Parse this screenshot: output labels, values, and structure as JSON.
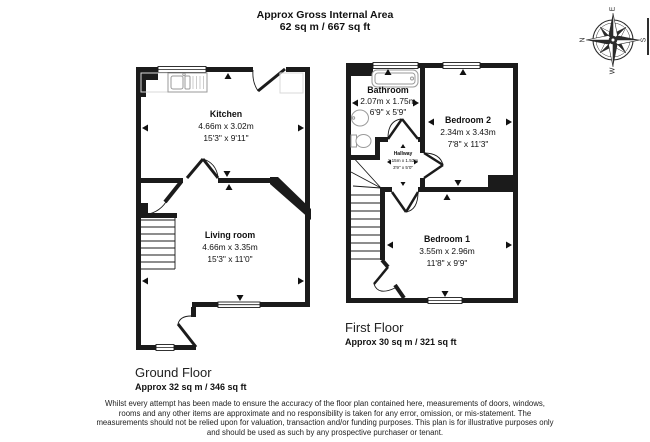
{
  "header": {
    "title": "Approx Gross Internal Area",
    "area_total": "62 sq m / 667 sq ft"
  },
  "compass": {
    "n": "N",
    "e": "E",
    "s": "S",
    "w": "W"
  },
  "ground_floor": {
    "title": "Ground Floor",
    "area": "Approx 32 sq m / 346 sq ft",
    "rooms": [
      {
        "name": "Kitchen",
        "metric": "4.66m x 3.02m",
        "imperial": "15'3\" x 9'11\""
      },
      {
        "name": "Living room",
        "metric": "4.66m x 3.35m",
        "imperial": "15'3\" x 11'0\""
      }
    ]
  },
  "first_floor": {
    "title": "First Floor",
    "area": "Approx 30 sq m / 321 sq ft",
    "rooms": [
      {
        "name": "Bathroom",
        "metric": "2.07m x 1.75m",
        "imperial": "6'9\" x 5'9\""
      },
      {
        "name": "Bedroom 2",
        "metric": "2.34m x 3.43m",
        "imperial": "7'8\" x 11'3\""
      },
      {
        "name": "Hallway",
        "metric": "1.15m x 1.53m",
        "imperial": "3'9\" x 5'0\""
      },
      {
        "name": "Bedroom 1",
        "metric": "3.55m x 2.96m",
        "imperial": "11'8\" x 9'9\""
      }
    ]
  },
  "disclaimer": "Whilst every attempt has been made to ensure the accuracy of the floor plan contained here, measurements of doors, windows, rooms and any other items are approximate and no responsibility is taken for any error, omission, or mis-statement. The measurements should not be relied upon for valuation, transaction and/or funding purposes. This plan is for illustrative purposes only and should be used as such by any prospective purchaser or tenant.",
  "colors": {
    "wall": "#1b1b1b",
    "fixture": "#9a9a9a",
    "text": "#111111"
  }
}
